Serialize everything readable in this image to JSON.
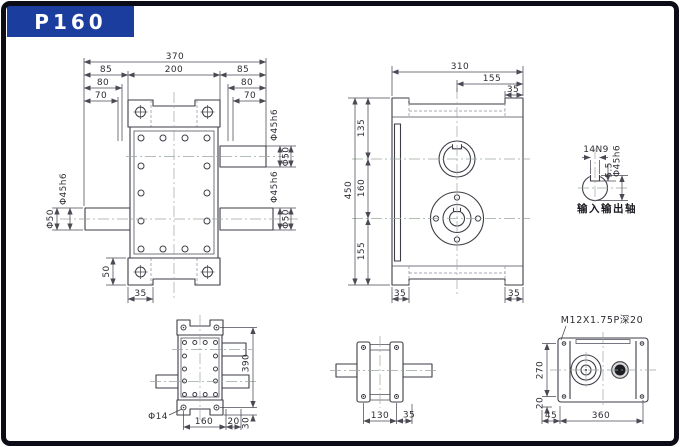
{
  "page": {
    "title": "P160",
    "accent_color": "#1b3e9e",
    "frame_color": "#0c0c16",
    "background": "#ffffff"
  },
  "front_view": {
    "d370": "370",
    "d200": "200",
    "d85_left": "85",
    "d85_right": "85",
    "d80_left": "80",
    "d80_right": "80",
    "d70_left": "70",
    "d70_right": "70",
    "upper_shaft_dia": "Φ45h6",
    "upper_shaft_od": "Φ50",
    "lower_shaft_dia": "Φ45h6",
    "lower_shaft_od": "Φ50",
    "left_shaft_dia": "Φ45h6",
    "left_shaft_od": "Φ50",
    "d50": "50",
    "d35": "35"
  },
  "side_view": {
    "d310": "310",
    "d155_top": "155",
    "d35_top": "35",
    "d450": "450",
    "d135": "135",
    "d160": "160",
    "d155_left": "155",
    "d35_bottom_left": "35",
    "d35_bottom_right": "35"
  },
  "shaft_detail": {
    "keyway_width": "14N9",
    "keyway_depth": "5.5",
    "shaft_dia": "Φ45h6",
    "caption": "输入输出轴"
  },
  "bottom_view": {
    "d390": "390",
    "d30": "30",
    "d160": "160",
    "d20": "20",
    "hole_dia": "Φ14"
  },
  "end_view": {
    "d130": "130",
    "d35": "35"
  },
  "rear_view": {
    "thread_spec": "M12X1.75P深20",
    "d270": "270",
    "d20": "20",
    "d45": "45",
    "d360": "360"
  }
}
